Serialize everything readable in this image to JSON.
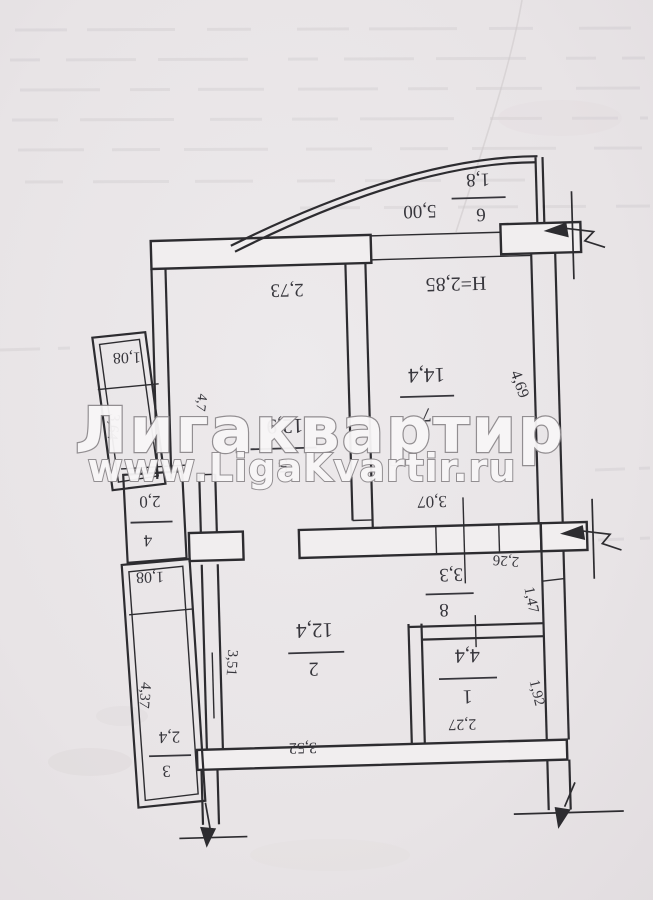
{
  "watermark": {
    "title": "Лигаквартир",
    "url": "www.LigaKvartir.ru"
  },
  "plan": {
    "ceiling_height": "H=2,85",
    "rooms": [
      {
        "number": "1",
        "area": "4,4"
      },
      {
        "number": "2",
        "area": "12,4"
      },
      {
        "number": "3",
        "area": "2,4"
      },
      {
        "number": "4",
        "area": "2,0"
      },
      {
        "number": "5",
        "area": "12,9"
      },
      {
        "number": "6",
        "area": "1,8"
      },
      {
        "number": "7",
        "area": "14,4"
      },
      {
        "number": "8",
        "area": "3,3"
      }
    ],
    "dims": {
      "w273": "2,73",
      "w500": "5,00",
      "w469": "4,69",
      "w47": "4,7",
      "w307": "3,07",
      "w226": "2,26",
      "w147": "1,47",
      "w192": "1,92",
      "w227": "2,27",
      "w352": "3,52",
      "w351": "3,51",
      "w364": "3,64",
      "w437": "4,37",
      "w108a": "1,08",
      "w108b": "1,08"
    }
  }
}
